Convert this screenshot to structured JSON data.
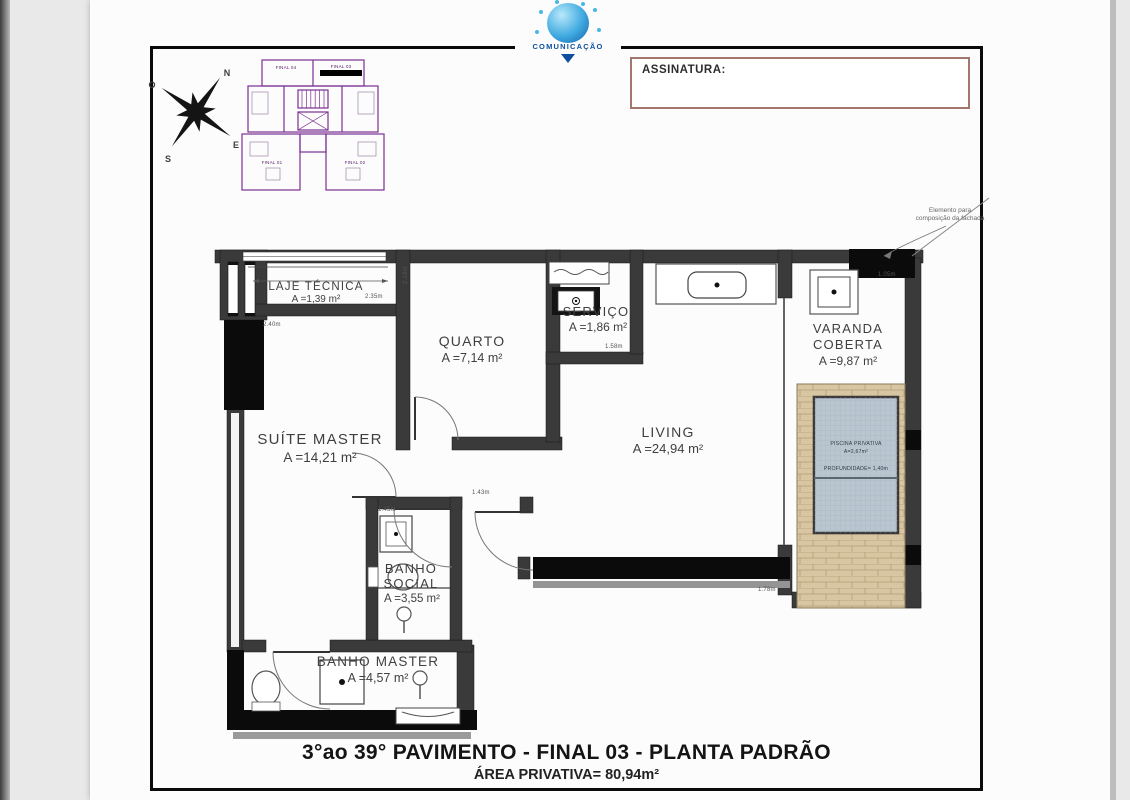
{
  "page": {
    "logo_text": "COMUNICAÇÃO",
    "signature_label": "ASSINATURA:",
    "title_line1": "3°ao 39° PAVIMENTO - FINAL 03 - PLANTA PADRÃO",
    "title_line2": "ÁREA PRIVATIVA= 80,94m²"
  },
  "compass": {
    "n": "N",
    "e": "E",
    "s": "S",
    "o": "O"
  },
  "key_plan": {
    "labels": [
      "FINAL 04",
      "FINAL 03",
      "FINAL 01",
      "FINAL 02"
    ],
    "highlighted_unit": "FINAL 03"
  },
  "rooms": {
    "laje_tecnica": {
      "name": "LAJE TÉCNICA",
      "area": "A =1,39 m²"
    },
    "quarto": {
      "name": "QUARTO",
      "area": "A =7,14 m²"
    },
    "servico": {
      "name": "SERVIÇO",
      "area": "A =1,86 m²"
    },
    "suite_master": {
      "name": "SUÍTE MASTER",
      "area": "A =14,21 m²"
    },
    "living": {
      "name": "LIVING",
      "area": "A =24,94 m²"
    },
    "varanda": {
      "name1": "VARANDA",
      "name2": "COBERTA",
      "area": "A =9,87 m²"
    },
    "banho_social": {
      "name1": "BANHO",
      "name2": "SOCIAL",
      "area": "A =3,55 m²"
    },
    "banho_master": {
      "name": "BANHO MASTER",
      "area": "A =4,57 m²"
    }
  },
  "pool": {
    "line1": "PISCINA PRIVATIVA",
    "line2": "A=2,67m²",
    "line3": "PROFUNDIDADE= 1,40m"
  },
  "annotation": {
    "line1": "Elemento para",
    "line2": "composição da fachada"
  },
  "dimensions": [
    {
      "label": "2.40m"
    },
    {
      "label": "2.35m"
    },
    {
      "label": "2.19m"
    },
    {
      "label": "1.58m"
    },
    {
      "label": "1.45m"
    },
    {
      "label": "1.43m"
    },
    {
      "label": "1.78m"
    },
    {
      "label": "1.05m"
    }
  ],
  "colors": {
    "wall": "#3a3a3a",
    "wall_black": "#0b0b0b",
    "keyplan_purple": "#7b2f92",
    "pool_water": "#b9c5cf",
    "deck": "#d8c6a2",
    "logo_blue": "#1460a8",
    "signature_border": "#a5766b"
  }
}
